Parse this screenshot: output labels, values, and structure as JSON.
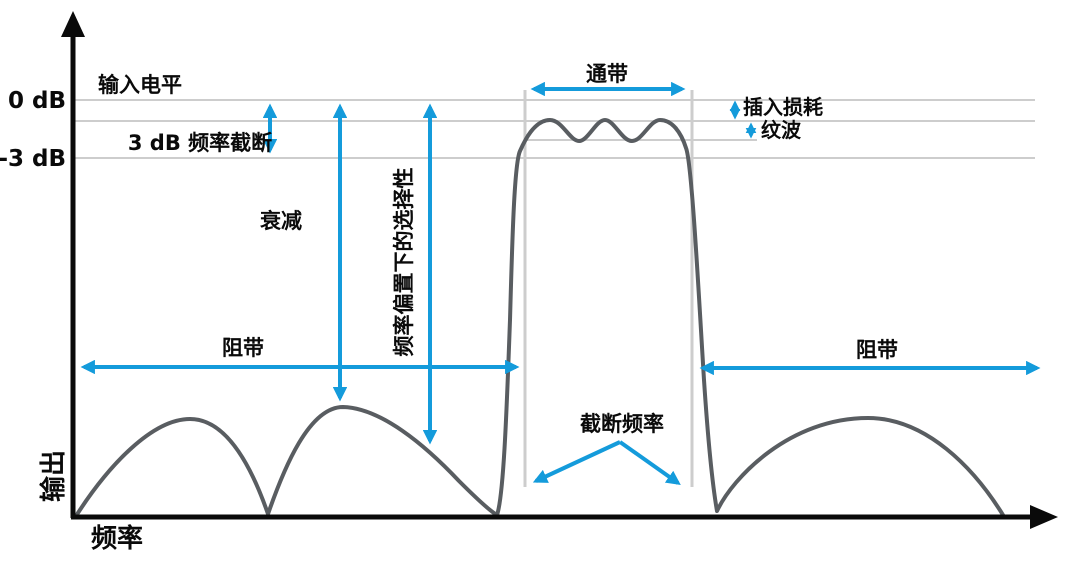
{
  "colors": {
    "accent": "#149bdb",
    "curve": "#595d61",
    "grid": "#cdcdcd",
    "axis": "#0a0a0a",
    "text": "#0a0a0a"
  },
  "y_axis": {
    "label": "输出",
    "tick_top": "0 dB",
    "tick_bottom": "-3 dB"
  },
  "x_axis": {
    "label": "频率"
  },
  "annotations": {
    "input_level": "输入电平",
    "cutoff_3db": "3 dB 频率截断",
    "attenuation": "衰减",
    "selectivity": "频率偏置下的选择性",
    "stopband_left": "阻带",
    "stopband_right": "阻带",
    "passband": "通带",
    "insertion_loss": "插入损耗",
    "ripple": "纹波",
    "cutoff_frequency": "截断频率"
  }
}
